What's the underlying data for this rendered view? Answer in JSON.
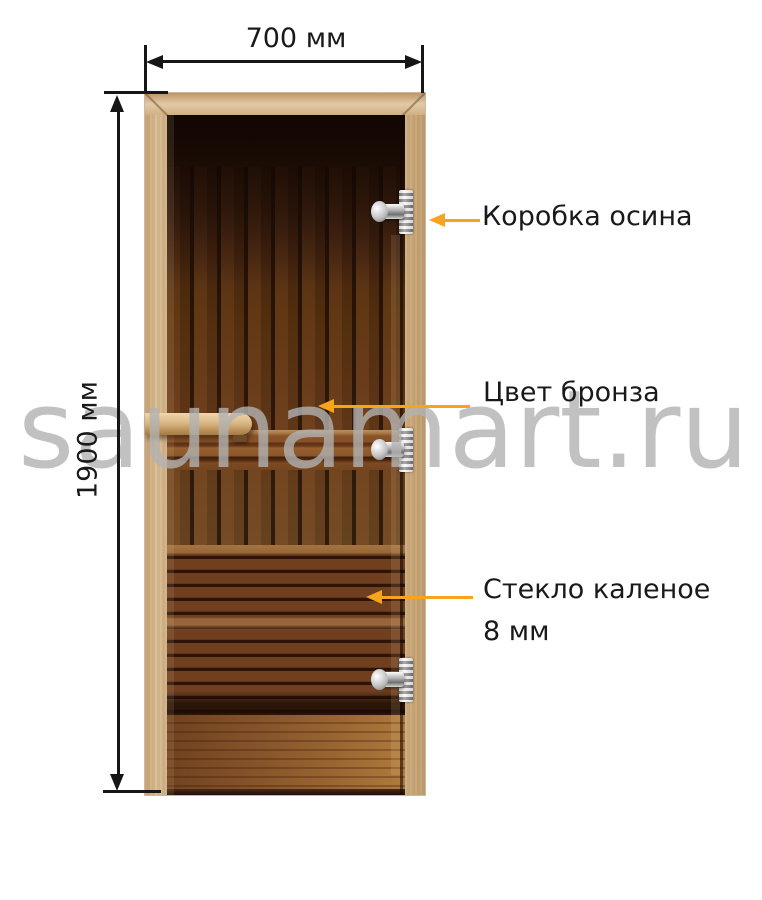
{
  "dimensions": {
    "width": {
      "label": "700 мм"
    },
    "height": {
      "label": "1900 мм"
    }
  },
  "callouts": {
    "frame": {
      "label": "Коробка осина"
    },
    "glass_color": {
      "label": "Цвет бронза"
    },
    "glass_type": {
      "line1": "Стекло каленое",
      "line2": "8 мм"
    }
  },
  "watermark": {
    "text": "saunamart.ru"
  },
  "colors": {
    "callout_arrow": "#f7a41d",
    "dimension_ink": "#161616",
    "watermark_gray": "#c9c9c9",
    "frame_wood_light": "#d8bc93",
    "glass_bronze_dark": "#5a3117",
    "floor_bronze_light": "#b07b3d",
    "hinge_chrome": "#cccccc"
  }
}
